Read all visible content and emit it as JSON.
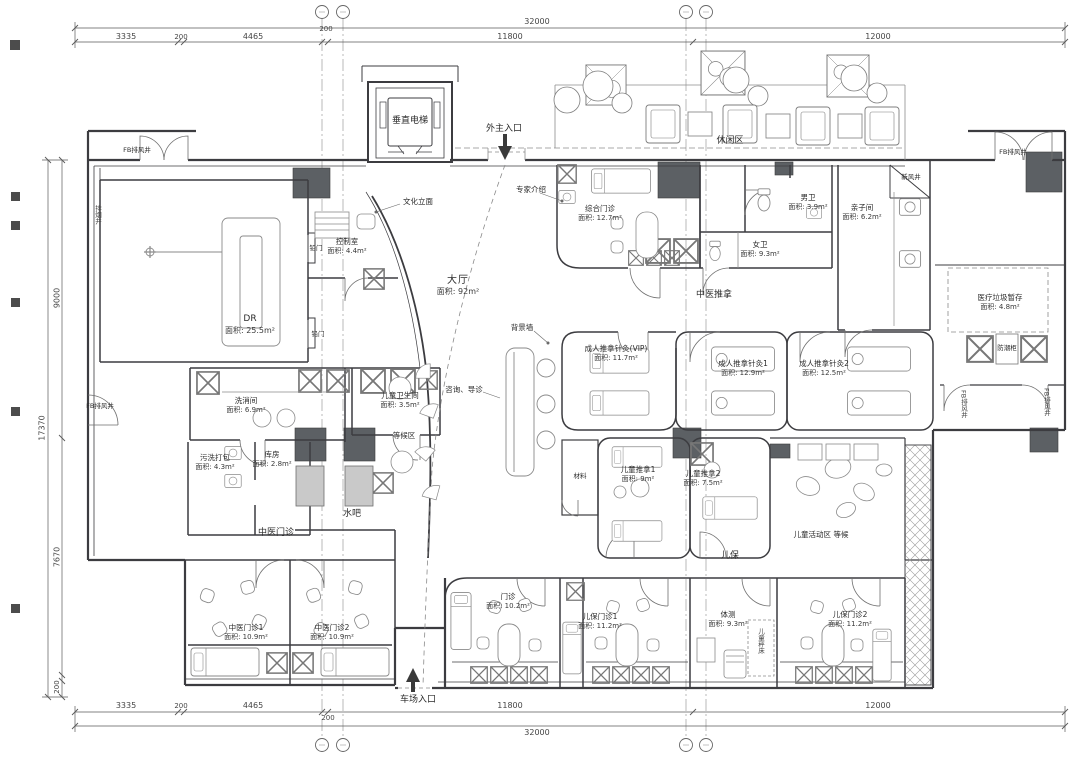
{
  "dims": {
    "top_total": "32000",
    "top": [
      "3335",
      "200",
      "4465",
      "200",
      "11800",
      "12000"
    ],
    "bottom": [
      "3335",
      "200",
      "4465",
      "200",
      "11800",
      "12000"
    ],
    "bottom_total": "32000",
    "left_total": "17370",
    "left": [
      "9000",
      "7670",
      "200"
    ]
  },
  "zones": {
    "hall": {
      "name": "大厅",
      "area": "面积: 92m²"
    },
    "leisure": "休闲区",
    "tcm_massage": "中医推拿",
    "tcm_clinic": "中医门诊",
    "child_care": "儿保",
    "waiting_area": "等候区",
    "water_bar": "水吧",
    "kids_activity": "儿童活动区 等候"
  },
  "labels": {
    "elevator": "垂直电梯",
    "entrance_main": "外主入口",
    "entrance_rear": "车场入口",
    "expert_intro": "专家介绍",
    "background_wall": "背景墙",
    "culture_facade": "文化立面",
    "consult_guide": "咨询、导诊",
    "lead_door": "铅门",
    "child_scale_bed": "儿童秤床",
    "material": "材料",
    "fresh_air_shaft": "新风井",
    "exhaust_shaft": "FB排风井",
    "smoke_shaft": "排烟井",
    "moisture_cabinet": "防潮柜"
  },
  "rooms": [
    {
      "name": "综合门诊",
      "area": "面积: 12.7m²"
    },
    {
      "name": "男卫",
      "area": "面积: 3.9m²"
    },
    {
      "name": "女卫",
      "area": "面积: 9.3m²"
    },
    {
      "name": "亲子间",
      "area": "面积: 6.2m²"
    },
    {
      "name": "医疗垃圾暂存",
      "area": "面积: 4.8m²"
    },
    {
      "name": "DR",
      "area": "面积: 25.5m²"
    },
    {
      "name": "控制室",
      "area": "面积: 4.4m²"
    },
    {
      "name": "洗消间",
      "area": "面积: 6.9m²"
    },
    {
      "name": "儿童卫生间",
      "area": "面积: 3.5m²"
    },
    {
      "name": "污洗打包",
      "area": "面积: 4.3m²"
    },
    {
      "name": "库房",
      "area": "面积: 2.8m²"
    },
    {
      "name": "中医门诊1",
      "area": "面积: 10.9m²"
    },
    {
      "name": "中医门诊2",
      "area": "面积: 10.9m²"
    },
    {
      "name": "成人推拿针灸(VIP)",
      "area": "面积: 11.7m²"
    },
    {
      "name": "成人推拿针灸1",
      "area": "面积: 12.9m²"
    },
    {
      "name": "成人推拿针灸2",
      "area": "面积: 12.5m²"
    },
    {
      "name": "儿童推拿1",
      "area": "面积: 9m²"
    },
    {
      "name": "儿童推拿2",
      "area": "面积: 7.5m²"
    },
    {
      "name": "门诊",
      "area": "面积: 10.2m²"
    },
    {
      "name": "儿保门诊1",
      "area": "面积: 11.2m²"
    },
    {
      "name": "体测",
      "area": "面积: 9.3m²"
    },
    {
      "name": "儿保门诊2",
      "area": "面积: 11.2m²"
    }
  ]
}
